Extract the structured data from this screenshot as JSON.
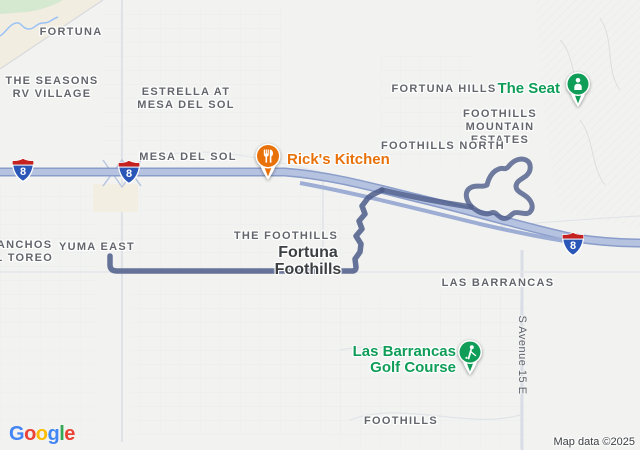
{
  "map": {
    "attribution": "Map data ©2025",
    "logo_letters": [
      {
        "ch": "G",
        "color": "#4285F4"
      },
      {
        "ch": "o",
        "color": "#EA4335"
      },
      {
        "ch": "o",
        "color": "#FBBC05"
      },
      {
        "ch": "g",
        "color": "#4285F4"
      },
      {
        "ch": "l",
        "color": "#34A853"
      },
      {
        "ch": "e",
        "color": "#EA4335"
      }
    ],
    "highway_shield": {
      "route": "8"
    },
    "area_labels": [
      {
        "id": "fortuna",
        "text": "FORTUNA"
      },
      {
        "id": "seasons-rv",
        "text": "THE SEASONS\nRV VILLAGE"
      },
      {
        "id": "estrella",
        "text": "ESTRELLA AT\nMESA DEL SOL"
      },
      {
        "id": "mesa-del-sol",
        "text": "MESA DEL SOL"
      },
      {
        "id": "fortuna-hills",
        "text": "FORTUNA HILLS"
      },
      {
        "id": "foothills-mountain-estates",
        "text": "FOOTHILLS\nMOUNTAIN\nESTATES"
      },
      {
        "id": "foothills-north",
        "text": "FOOTHILLS NORTH"
      },
      {
        "id": "the-foothills",
        "text": "THE FOOTHILLS"
      },
      {
        "id": "yuma-east",
        "text": "YUMA EAST"
      },
      {
        "id": "ranchos-el-toreo",
        "text": "RANCHOS\nEL TOREO"
      },
      {
        "id": "las-barrancas",
        "text": "LAS BARRANCAS"
      },
      {
        "id": "foothills",
        "text": "FOOTHILLS"
      }
    ],
    "locality_label": "Fortuna\nFoothills",
    "road_label": "S Avenue 15 E",
    "pois": {
      "ricks": {
        "label": "Rick's Kitchen",
        "color": "#E8710A"
      },
      "seat": {
        "label": "The Seat",
        "color": "#0F9D58"
      },
      "golf": {
        "label": "Las Barrancas\nGolf Course",
        "color": "#0F9D58"
      }
    },
    "boundary_color": "#4E5C8A",
    "highway_color": "#8A9CC9"
  }
}
